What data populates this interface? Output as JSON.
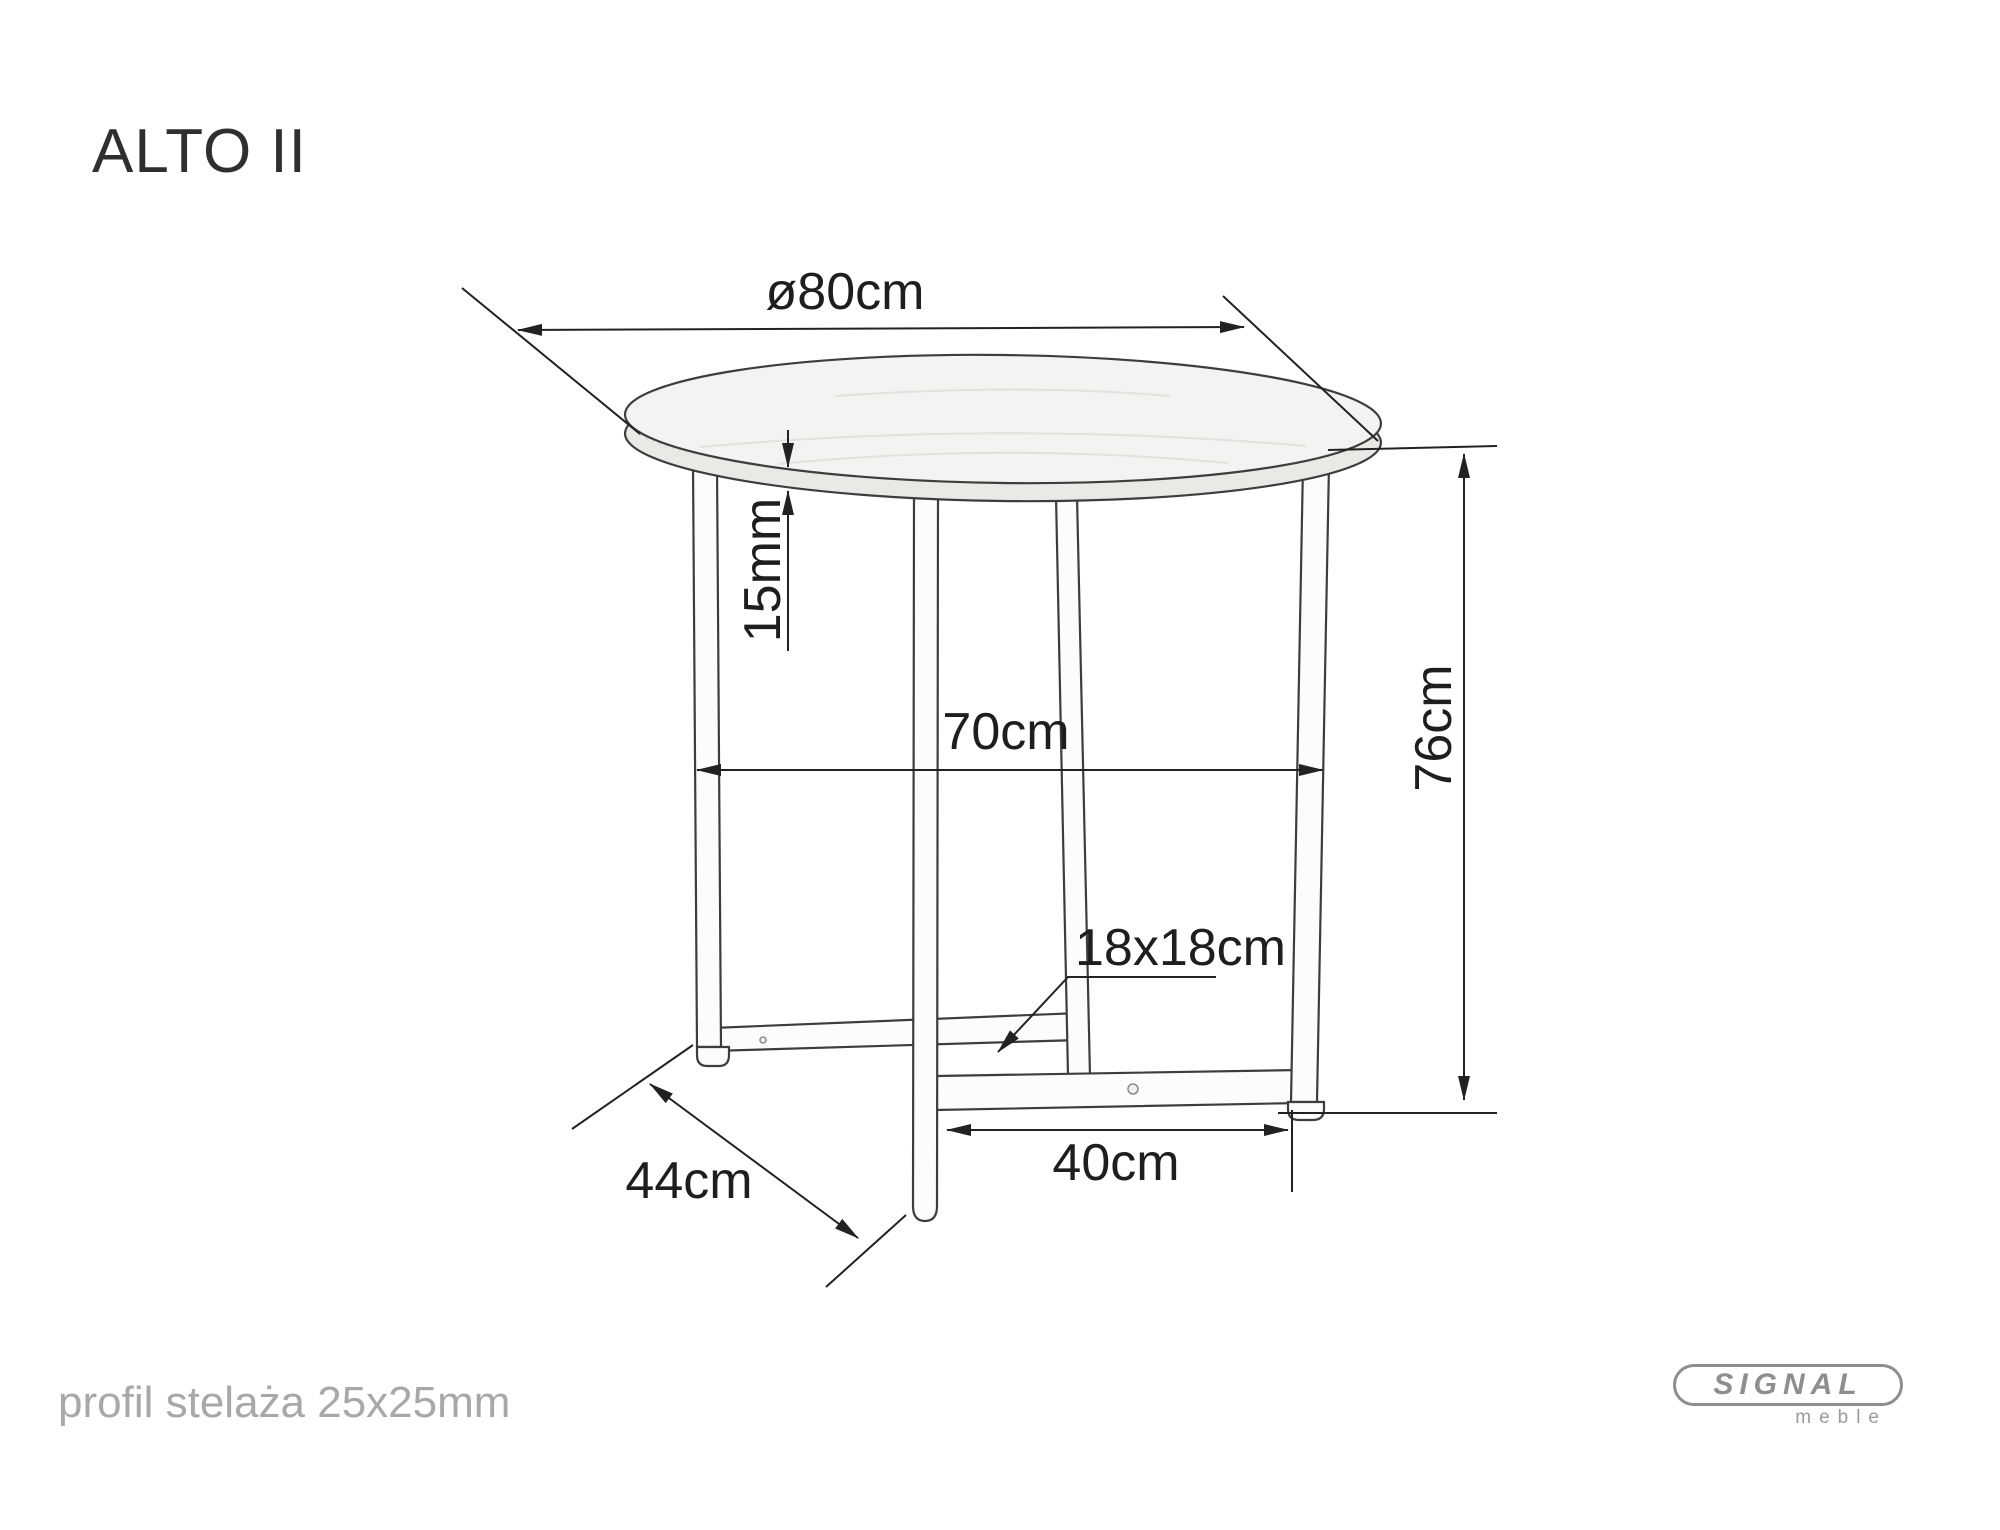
{
  "page": {
    "title": "ALTO II",
    "footer_note": "profil stelaża 25x25mm"
  },
  "logo": {
    "brand": "SIGNAL",
    "tagline": "meble"
  },
  "drawing": {
    "product": "ALTO II",
    "view": "perspective technical drawing of round table with cross metal frame",
    "labels": {
      "diameter": "ø80cm",
      "top_thickness": "15mm",
      "frame_width": "70cm",
      "height": "76cm",
      "leg_profile": "18x18cm",
      "base_bar": "40cm",
      "depth": "44cm"
    },
    "colors": {
      "outline": "#3d3d3d",
      "dimension": "#222222",
      "top_fill": "#f3f3f1",
      "edge_fill": "#e9e9e6",
      "muted_text": "#a8a8a8",
      "logo_gray": "#8e8e8e",
      "background": "#ffffff"
    }
  }
}
